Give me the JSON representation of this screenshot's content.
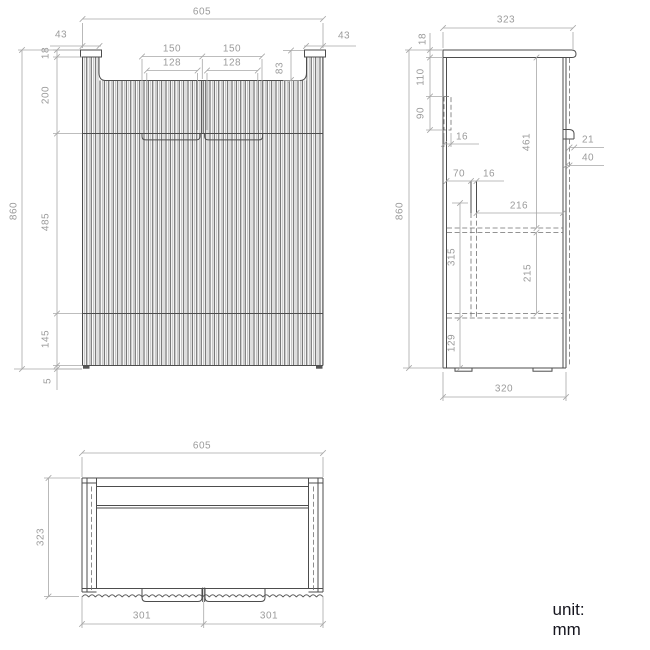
{
  "unit_label": "unit: mm",
  "front_view": {
    "overall_width": "605",
    "side_margin_left": "43",
    "side_margin_right": "43",
    "handle_width_left": "150",
    "handle_width_right": "150",
    "handle_inner_left": "128",
    "handle_inner_right": "128",
    "top_recess": "83",
    "cap_thickness": "18",
    "upper_section": "200",
    "overall_height": "860",
    "door_section": "485",
    "lower_section": "145",
    "plinth_height": "5"
  },
  "side_view": {
    "overall_depth": "323",
    "top_thickness": "18",
    "rail_top_offset": "110",
    "rail_height": "90",
    "rail_thickness": "16",
    "interior_height": "461",
    "handle_projection": "21",
    "handle_profile": "40",
    "runner_offset": "70",
    "runner_thickness": "16",
    "interior_depth": "216",
    "drawer_zone_height": "315",
    "drawer_inner_height": "215",
    "bottom_offset": "129",
    "overall_height": "860",
    "base_depth": "320"
  },
  "top_view": {
    "overall_width": "605",
    "overall_depth": "323",
    "door_width_left": "301",
    "door_width_right": "301"
  },
  "colors": {
    "geometry_line": "#4d4d4d",
    "dimension_line": "#a8a8a8",
    "dimension_text": "#9b9b9b",
    "background": "#ffffff"
  }
}
